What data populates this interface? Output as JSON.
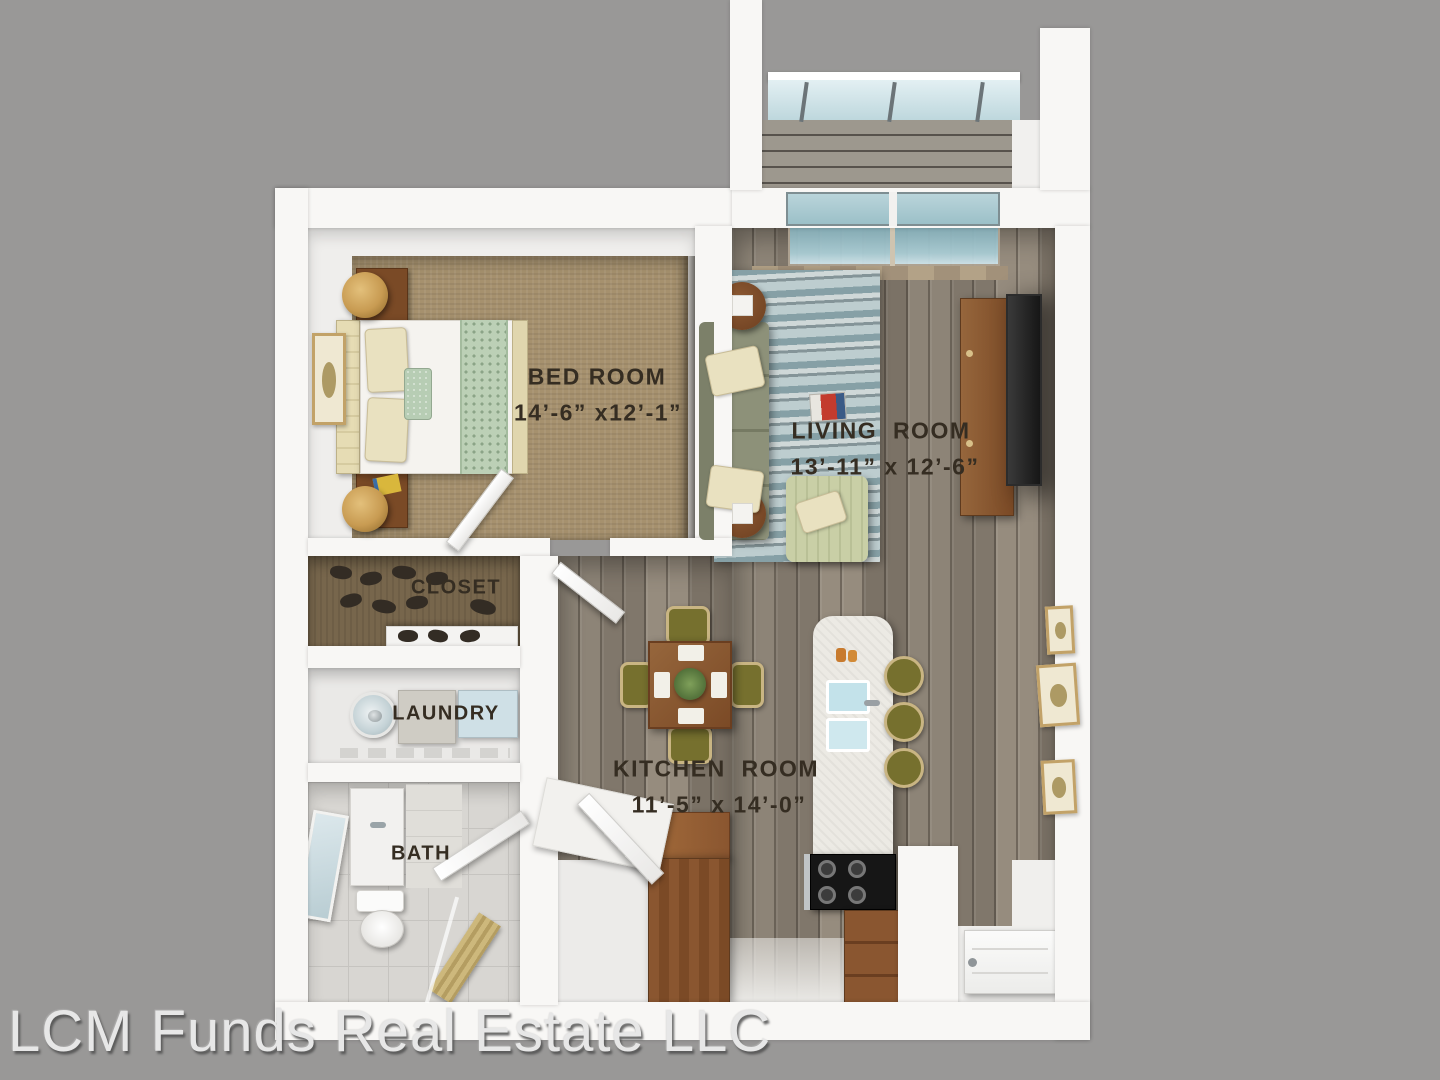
{
  "watermark": "LCM Funds Real Estate LLC",
  "rooms": {
    "bedroom": {
      "name": "BED ROOM",
      "size": "14’-6” x12’-1”"
    },
    "living": {
      "name": "LIVING  ROOM",
      "size": "13’-11” x 12’-6”"
    },
    "kitchen": {
      "name": "KITCHEN  ROOM",
      "size": "11’-5” x 14’-0”"
    },
    "closet": {
      "name": "CLOSET"
    },
    "laundry": {
      "name": "LAUNDRY"
    },
    "bath": {
      "name": "BATH"
    }
  },
  "colors": {
    "background": "#999897",
    "wall": "#f8f7f5",
    "label_text": "#352d22",
    "carpet": "#a6916e",
    "wood_floor": "#8a8176",
    "closet_floor": "#77664c",
    "window_glass": "#a9ccd4",
    "sofa_green": "#8d9179",
    "armchair_green": "#c9cfa6",
    "furniture_wood": "#82512d",
    "olive_chair": "#76702e",
    "watermark_text": "#e7e7e7"
  }
}
